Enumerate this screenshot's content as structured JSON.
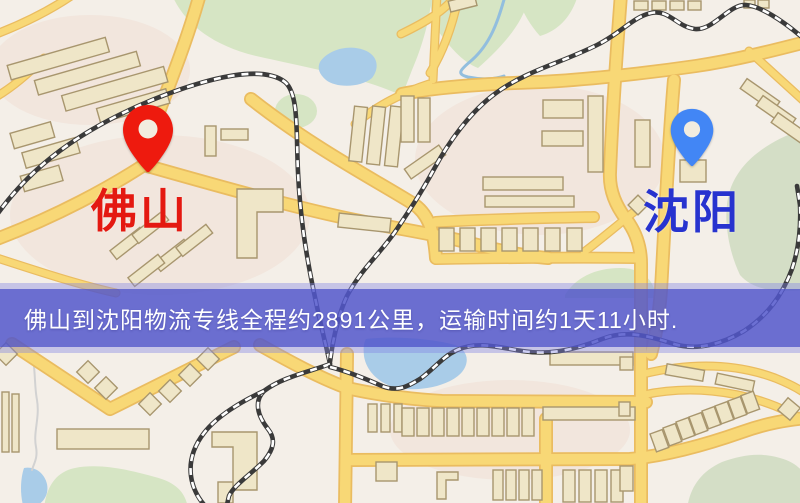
{
  "map": {
    "origin_label": "佛山",
    "destination_label": "沈阳"
  },
  "banner": {
    "text": "佛山到沈阳物流专线全程约2891公里，运输时间约1天11小时.",
    "distance_km": "2891",
    "duration": "1天11小时"
  },
  "colors": {
    "pin_red": "#ee1a0e",
    "pin_blue": "#4286f5",
    "origin_label_color": "#e41911",
    "destination_label_color": "#2733cf",
    "banner_bg": "#5257cbd9",
    "banner_text_color": "#ffffff",
    "road_yellow": "#f8d876",
    "road_casing": "#eabc60",
    "map_background": "#f4efe8",
    "park_green": "#d6e5c4",
    "water_blue": "#a9cce8",
    "railway_dark": "#3a3a3a"
  }
}
